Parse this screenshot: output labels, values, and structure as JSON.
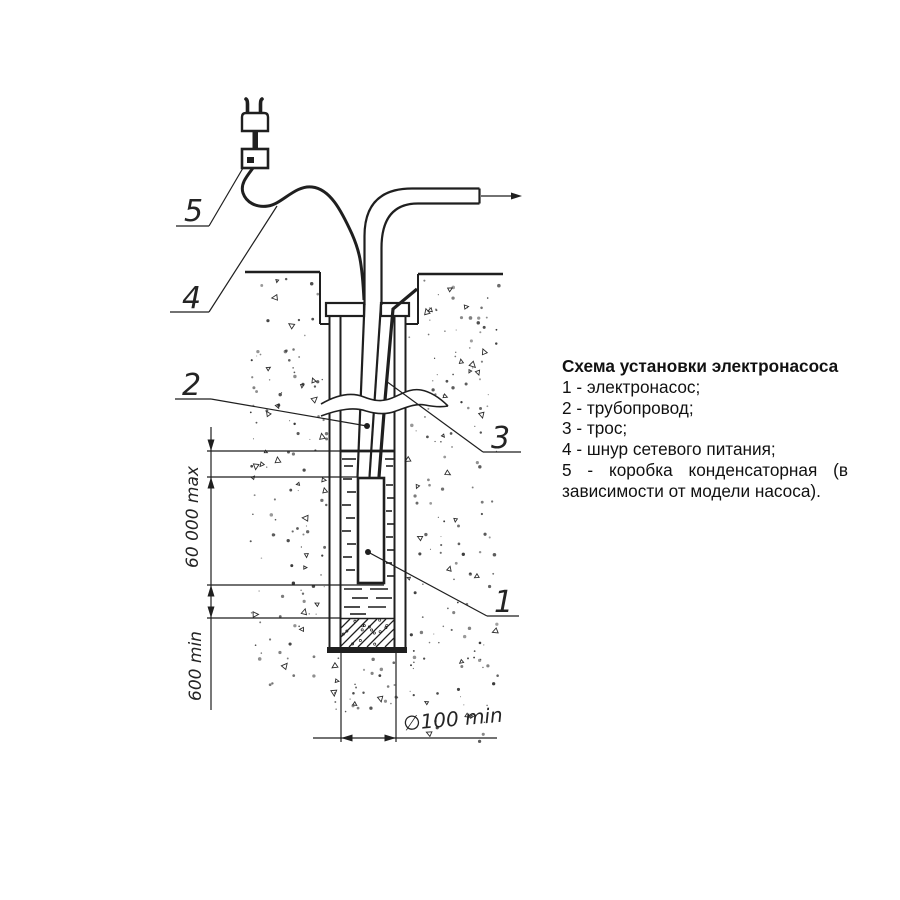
{
  "colors": {
    "ink": "#1f1f1f",
    "background": "#ffffff"
  },
  "legend": {
    "title": "Схема установки электронасоса",
    "items": [
      {
        "text": "1 - электронасос;"
      },
      {
        "text": "2 - трубопровод;"
      },
      {
        "text": "3 - трос;"
      },
      {
        "text": "4 - шнур сетевого питания;"
      },
      {
        "text": "5 - коробка конденсаторная (в",
        "stretch": true
      },
      {
        "text": "зависимости от модели насоса)."
      }
    ]
  },
  "diagram": {
    "part_labels": {
      "pump": "1",
      "pipe": "2",
      "rope": "3",
      "cord": "4",
      "capacitor_box": "5"
    },
    "dimensions": {
      "immersion_depth_max": "60 000 max",
      "bottom_clearance_min": "600 min",
      "well_diameter_min": "∅100 min"
    }
  }
}
